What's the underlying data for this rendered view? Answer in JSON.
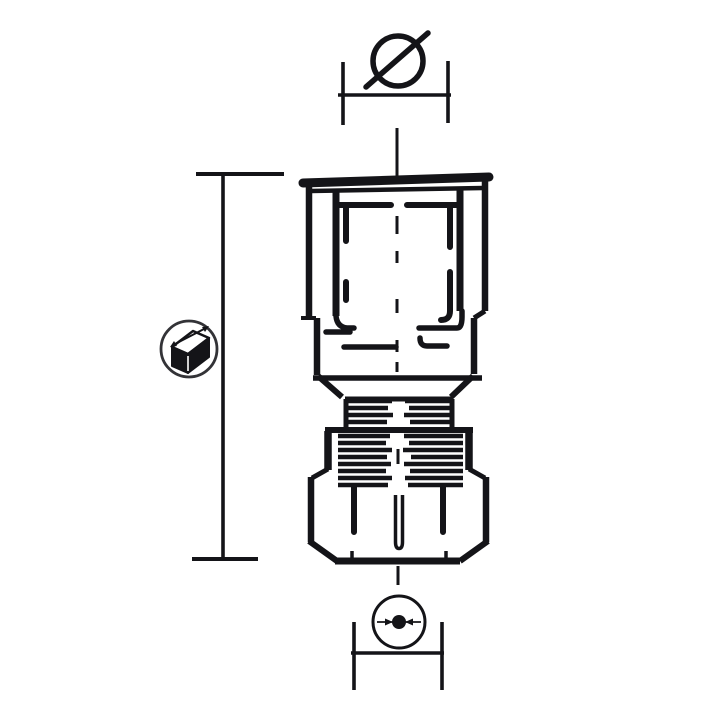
{
  "colors": {
    "background": "#ffffff",
    "ink": "#141418",
    "symbol_ring": "#333337"
  },
  "symbols": {
    "diameter": {
      "icon_name": "diameter-symbol",
      "glyph": "Ø",
      "meaning_label": "thread diameter dimension"
    },
    "length": {
      "icon_name": "length-3d-box-icon",
      "meaning_label": "overall length dimension"
    },
    "tube_od": {
      "icon_name": "tube-od-dot-icon",
      "meaning_label": "tube outer diameter dimension"
    }
  }
}
